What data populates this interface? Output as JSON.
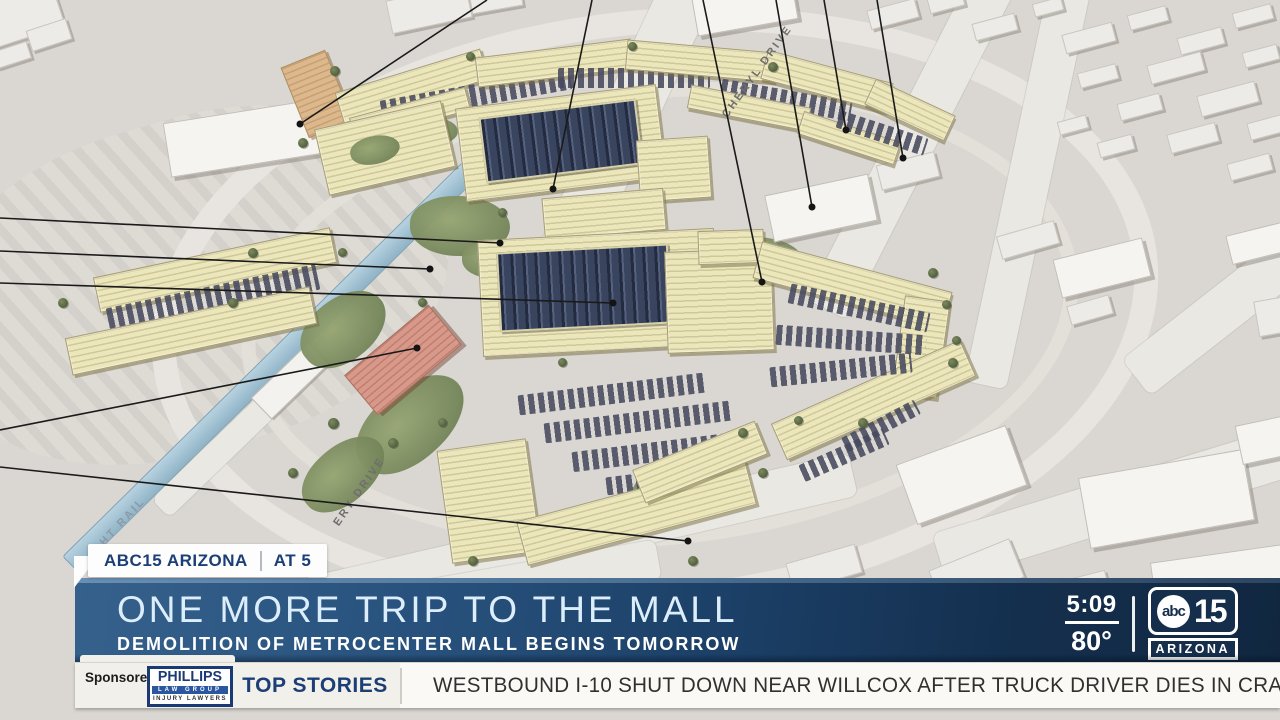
{
  "badge": {
    "station": "ABC15 ARIZONA",
    "program": "AT 5"
  },
  "lower_third": {
    "headline": "ONE MORE TRIP TO THE MALL",
    "subheadline": "DEMOLITION OF METROCENTER MALL BEGINS TOMORROW",
    "time": "5:09",
    "temperature": "80°"
  },
  "logo": {
    "network": "abc",
    "channel": "15",
    "region": "ARIZONA"
  },
  "ticker": {
    "sponsored_by": "Sponsored by:",
    "sponsor_name": "PHILLIPS",
    "sponsor_sub": "LAW GROUP",
    "sponsor_tag": "INJURY LAWYERS",
    "section": "TOP STORIES",
    "text": "WESTBOUND I-10 SHUT DOWN NEAR WILLCOX AFTER TRUCK DRIVER DIES IN CRASH."
  },
  "rendering": {
    "street_label_north": "CHERYL DRIVE",
    "street_label_west": "ERY DRIVE",
    "rail_label": "LIGHT RAIL"
  },
  "colors": {
    "banner_blue_left": "#2e5a84",
    "banner_blue_right": "#102840",
    "navy_text": "#1c3e76",
    "headline_tint": "#dceefb",
    "ticker_bg": "#f2f0ea",
    "logo_navy": "#142e4b",
    "sponsor_navy": "#1b3a75"
  }
}
